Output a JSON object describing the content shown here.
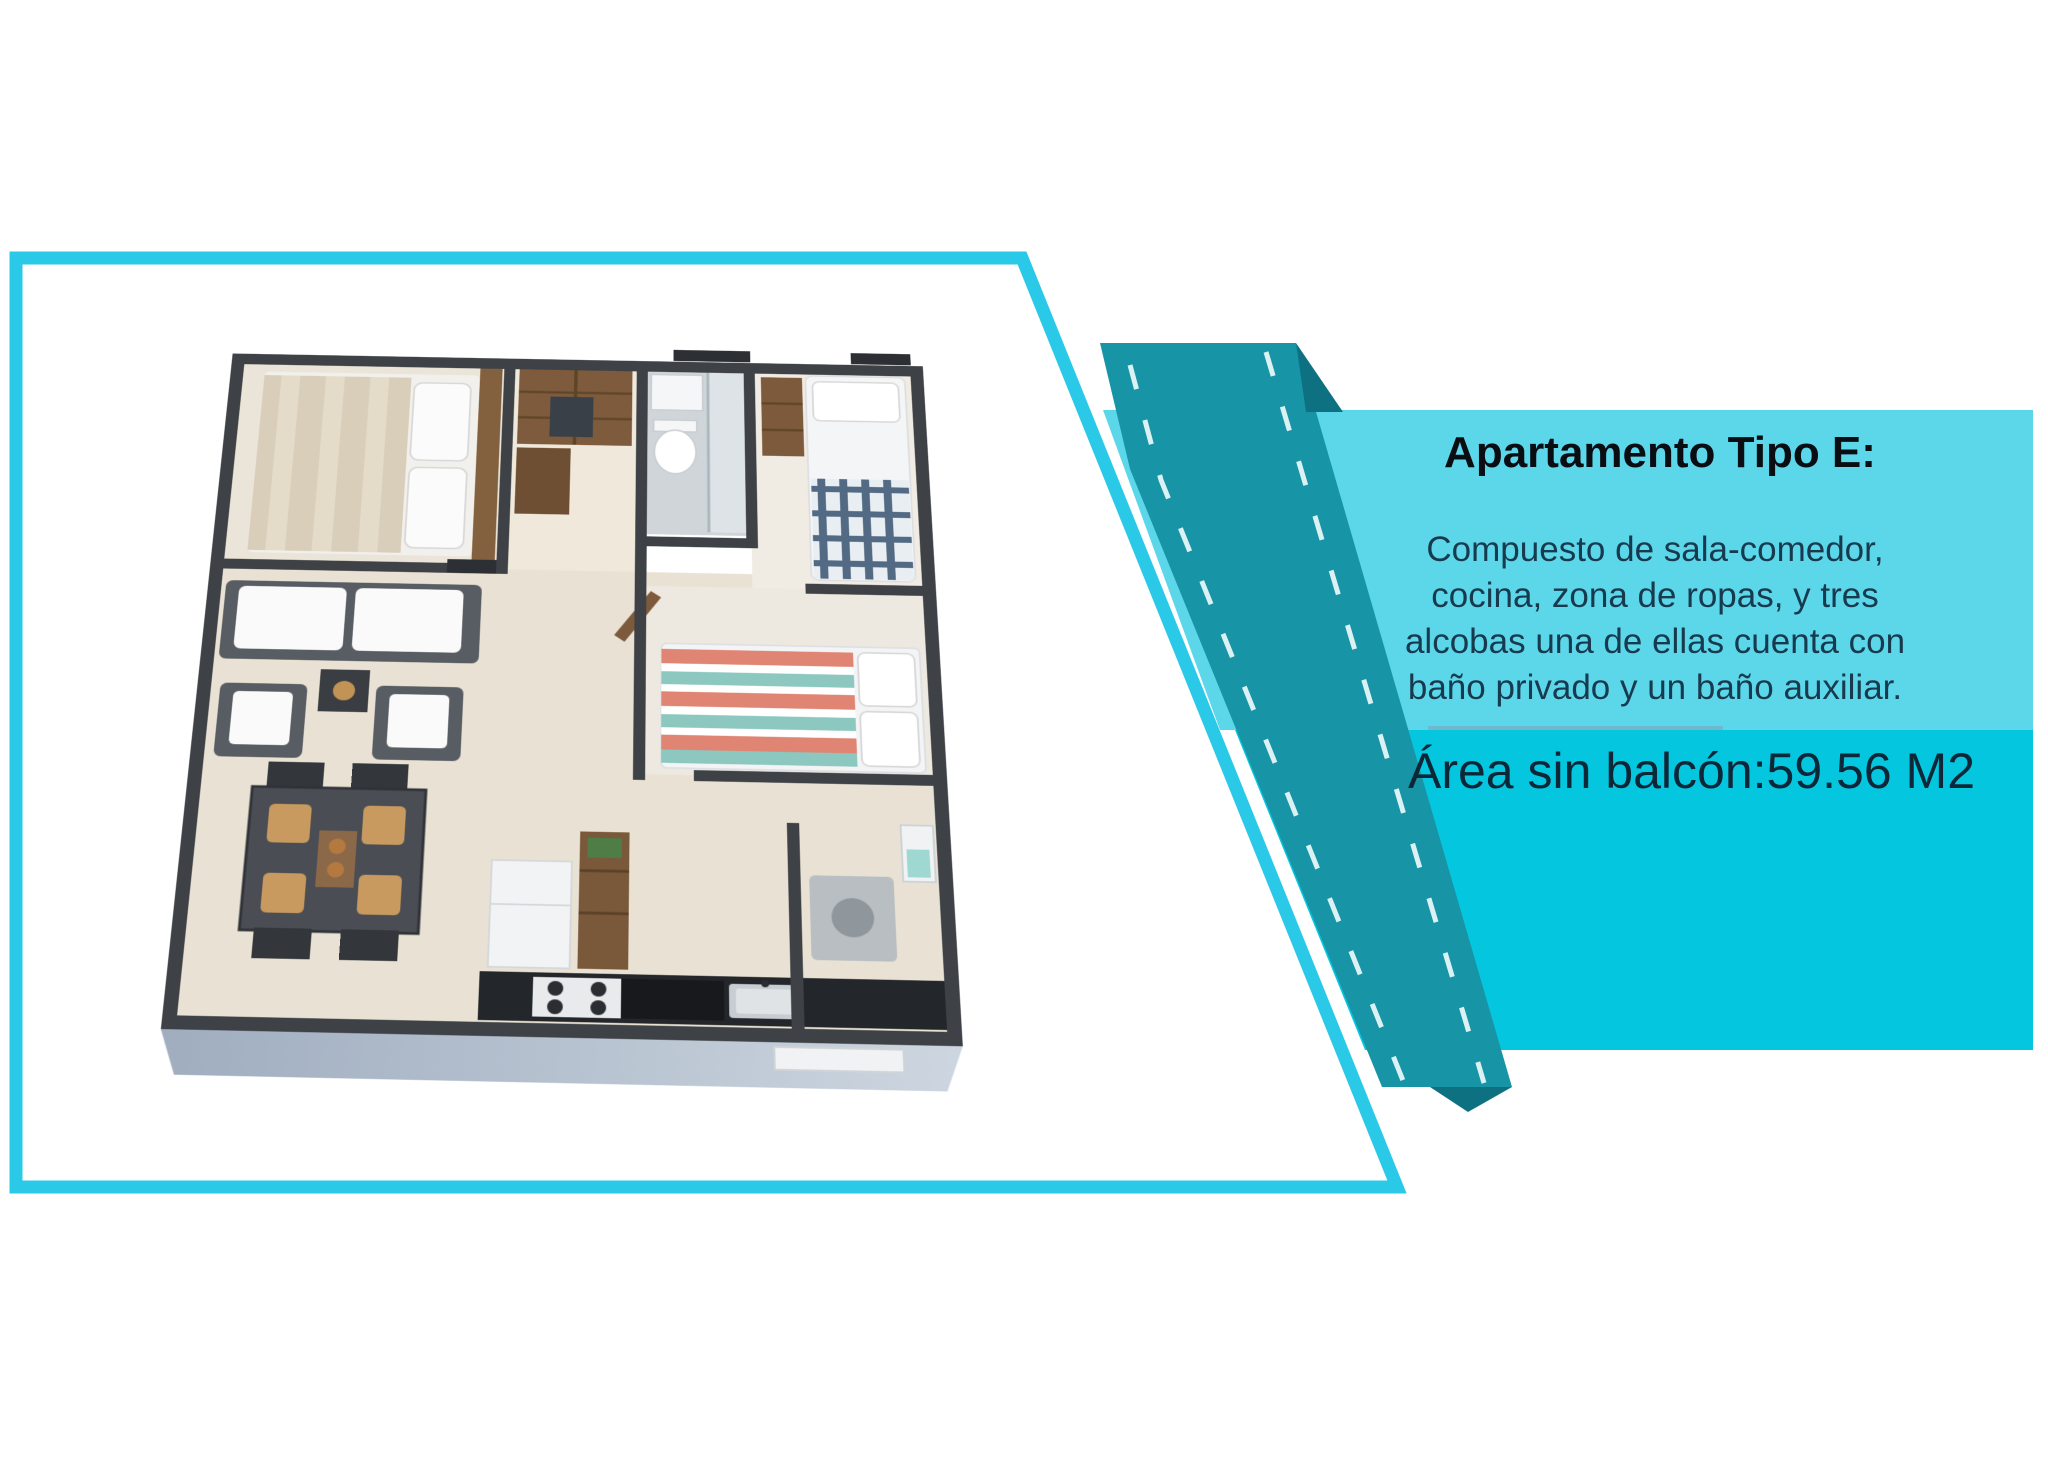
{
  "info_panel": {
    "title": "Apartamento Tipo E:",
    "description_lines": [
      "Compuesto de sala-comedor,",
      "cocina, zona de ropas, y tres",
      "alcobas una de ellas cuenta con",
      "baño privado y un baño auxiliar."
    ],
    "area_text": "Área sin balcón:59.56 M2"
  },
  "colors": {
    "frame_border": "#2bc9e8",
    "road_band": "#1795a6",
    "road_fold": "#0d7181",
    "lane_dash": "#eef9fb",
    "panel_light": "#5cd6e9",
    "panel_medium": "#04c7df",
    "panel_underline": "#7fa3bd",
    "title_text": "#0a0d12",
    "body_text": "#173a4e",
    "area_text": "#0c2738"
  },
  "floor_plan": {
    "rooms": [
      "master-bedroom",
      "closet-hall",
      "bathroom",
      "bedroom-2",
      "bedroom-3",
      "living-room",
      "dining-area",
      "kitchen",
      "laundry-zone"
    ]
  }
}
